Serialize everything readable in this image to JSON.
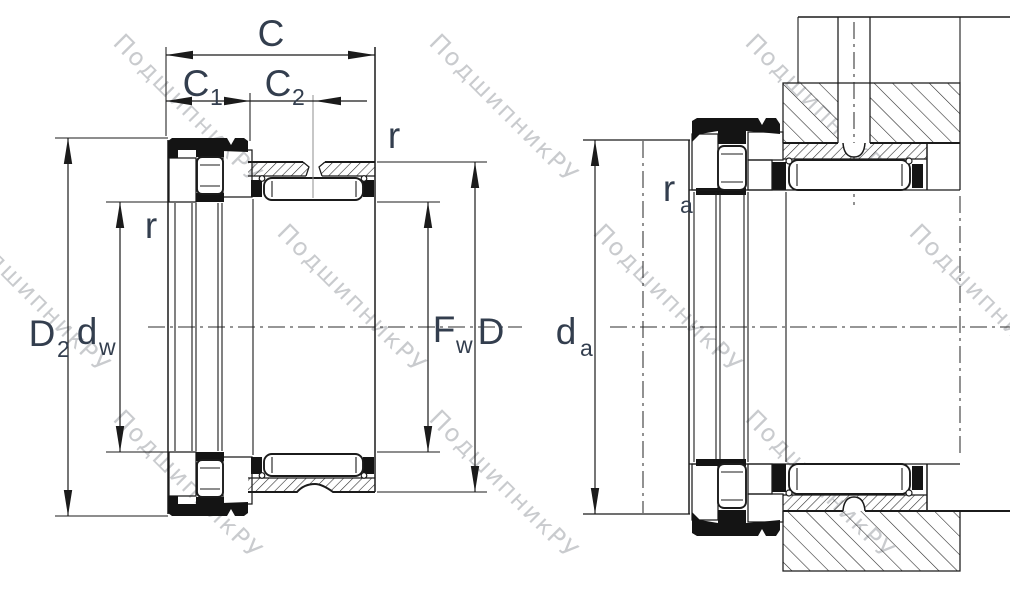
{
  "watermark": {
    "text": "ПодшипникРУ"
  },
  "colors": {
    "line": "#1b1b1b",
    "dimension_text": "#333e4e",
    "watermark": "#c9cbce"
  },
  "labels": {
    "c": {
      "main": "C"
    },
    "c1": {
      "main": "C",
      "sub": "1"
    },
    "c2": {
      "main": "C",
      "sub": "2"
    },
    "r_top": {
      "main": "r"
    },
    "r_bore": {
      "main": "r"
    },
    "d2": {
      "main": "D",
      "sub": "2"
    },
    "dw": {
      "main": "d",
      "sub": "w"
    },
    "fw": {
      "main": "F",
      "sub": "w"
    },
    "d": {
      "main": "D"
    },
    "da": {
      "main": "d",
      "sub": "a"
    },
    "ra": {
      "main": "r",
      "sub": "a"
    }
  }
}
